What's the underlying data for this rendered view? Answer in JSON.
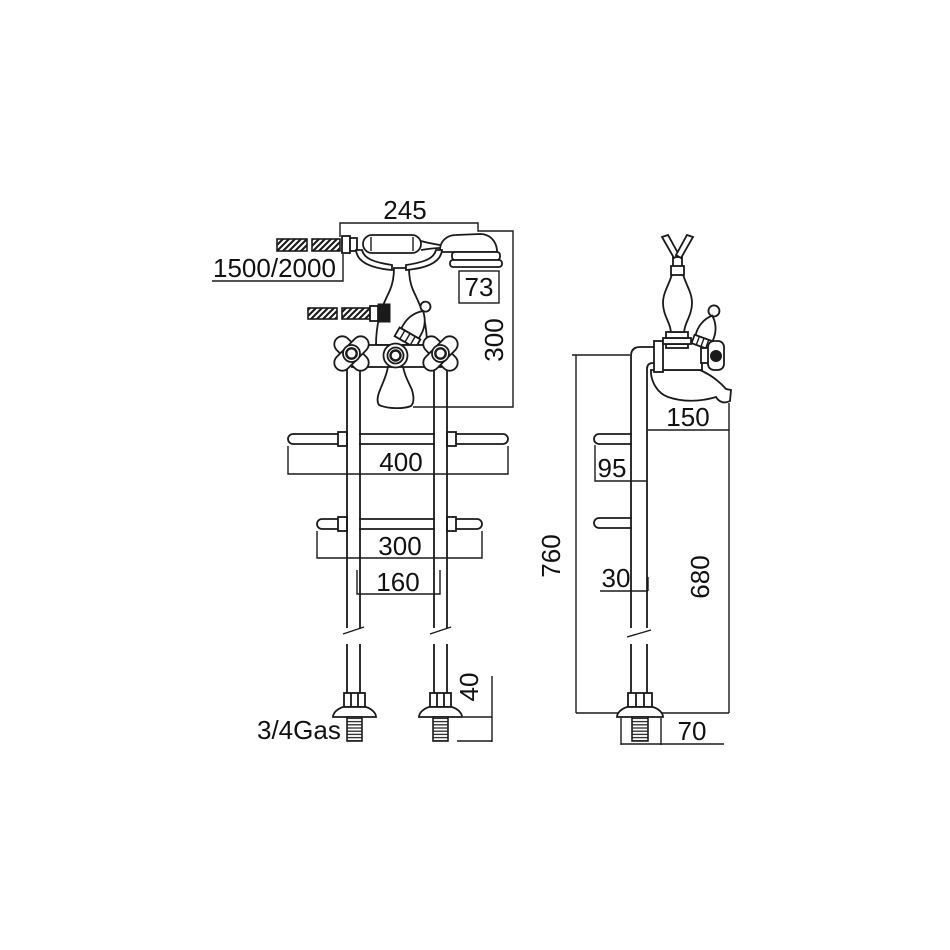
{
  "page": {
    "background": "#ffffff",
    "line_color": "#1a1a1a",
    "text_color": "#111111",
    "description": "Technical dimension drawing of floor-standing bath mixer tap with hand shower, front and side views"
  },
  "front_view": {
    "dimensions": {
      "handset_width": "245",
      "hose_length": "1500/2000",
      "head_width": "73",
      "handset_height": "300",
      "upper_bracket_width": "400",
      "lower_bracket_width": "300",
      "pipe_spacing": "160",
      "thread_length": "40",
      "thread_size": "3/4Gas"
    }
  },
  "side_view": {
    "dimensions": {
      "spout_reach": "150",
      "bracket_offset": "95",
      "total_height": "760",
      "pipe_offset": "30",
      "spout_height": "680",
      "base_width": "70"
    }
  }
}
